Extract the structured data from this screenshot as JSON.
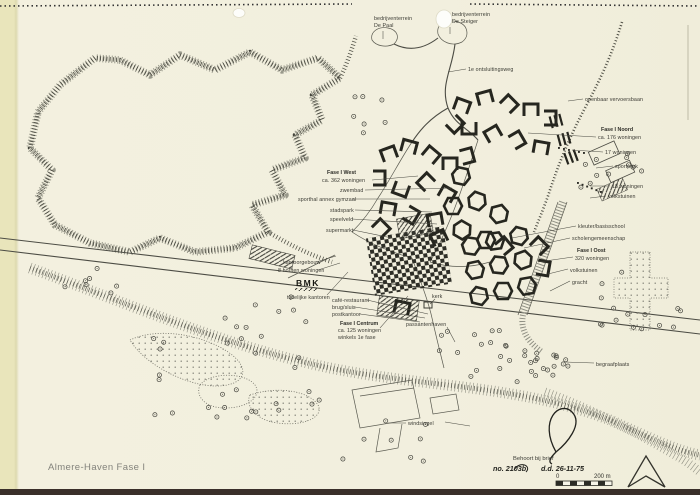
{
  "title": "Almere-Haven Fase I",
  "labels": {
    "de_paal": [
      "bedrijventerrein",
      "De Paal"
    ],
    "de_steiger": [
      "bedrijventerrein",
      "De Steiger"
    ],
    "ontsluitingsweg": "1e ontsluitingsweg",
    "ov_baan": "openbaar vervoersbaan",
    "fase_noord": [
      "Fase I Noord",
      "ca. 176 woningen"
    ],
    "w17": "17 woningen",
    "sportpark": "sportpark",
    "w18": "18 woningen",
    "volkstuinen_n": "volkstuinen",
    "fase_west": [
      "Fase I West",
      "ca. 362 woningen"
    ],
    "zwembad": "zwembad",
    "sporthal": "sporthal annex gymzaal",
    "stadspark": "stadspark",
    "speelveld": "speelveld",
    "supermarkt": "supermarkt",
    "kantoorgebouw": "kantoorgebouw",
    "houten": "8 houten woningen",
    "bmk": "BMK",
    "tijdelijke": "tijdelijke kantoren",
    "cafe": "café-restaurant",
    "brug": "brug/sluis",
    "postkantoor": "postkantoor",
    "fase_centrum": [
      "Fase I Centrum",
      "ca. 125 woningen",
      "winkels 1e fase"
    ],
    "kerk": "kerk",
    "passantenhaven": "passantenhaven",
    "kleuterschool": "kleuter/basisschool",
    "scholengemeenschap": "scholengemeenschap",
    "fase_oost": [
      "Fase I Oost",
      "320 woningen"
    ],
    "volkstuinen_o": "volkstuinen",
    "gracht": "gracht",
    "begraafplaats": "begraafplaats",
    "windsingel": "windsingel"
  },
  "stamp": {
    "note": "Behoort bij brief",
    "ref": "no. 2103b",
    "date": "d.d. 26-11-75"
  },
  "scale": {
    "zero": "0",
    "end": "200 m"
  },
  "colors": {
    "paper": "#f2efde",
    "edge_strip": "#e9e5bb",
    "ink": "#3c3c36"
  }
}
